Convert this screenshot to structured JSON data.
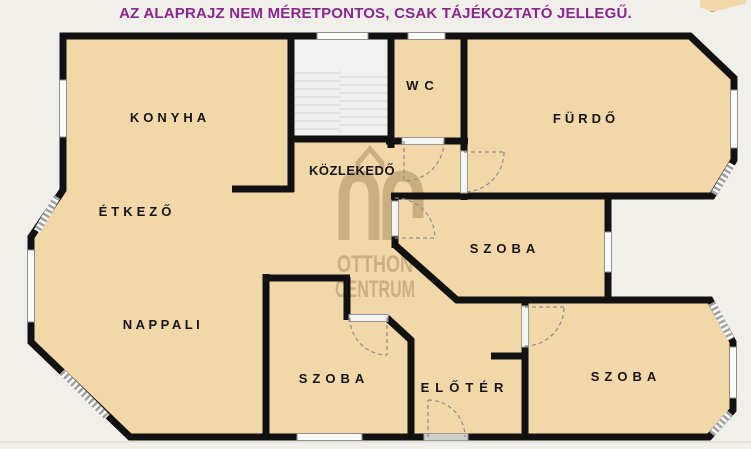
{
  "page": {
    "disclaimer": "AZ ALAPRAJZ NEM MÉRETPONTOS, CSAK TÁJÉKOZTATÓ JELLEGŰ."
  },
  "watermark": {
    "brand_line1": "OTTHON",
    "brand_line2": "CENTRUM"
  },
  "rooms": {
    "konyha": "KONYHA",
    "etkezo": "ÉTKEZŐ",
    "nappali": "NAPPALI",
    "kozlekedo": "KÖZLEKEDŐ",
    "wc": "WC",
    "furdo": "FÜRDŐ",
    "szoba_middle": "SZOBA",
    "szoba_bottom": "SZOBA",
    "szoba_right": "SZOBA",
    "eloter": "ELŐTÉR"
  },
  "colors": {
    "disclaimer_text": "#8B268E",
    "background": "#F1EFE9",
    "floor": "#F2D8A9",
    "wall": "#111111",
    "watermark_brown": "#8F7348",
    "label_text": "#141414",
    "staircase": "#F1F1F1"
  }
}
